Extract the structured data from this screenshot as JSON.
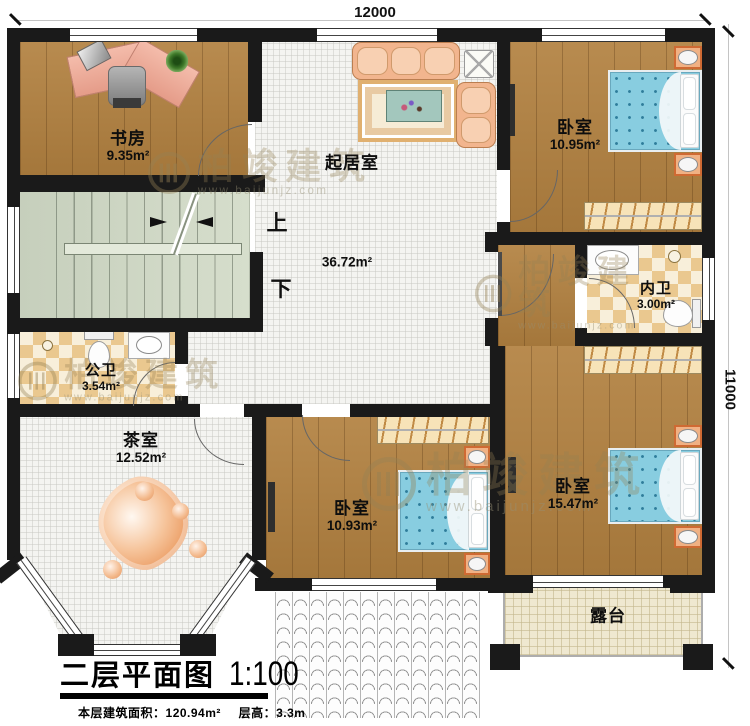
{
  "plan": {
    "dim_top": "12000",
    "dim_right": "11000",
    "stair_up": "上",
    "stair_down": "下"
  },
  "rooms": {
    "study": {
      "name": "书房",
      "area": "9.35m²"
    },
    "living": {
      "name": "起居室",
      "area": "36.72m²"
    },
    "bedroom_top_right": {
      "name": "卧室",
      "area": "10.95m²"
    },
    "inner_bath": {
      "name": "内卫",
      "area": "3.00m²"
    },
    "public_bath": {
      "name": "公卫",
      "area": "3.54m²"
    },
    "tea_room": {
      "name": "茶室",
      "area": "12.52m²"
    },
    "bedroom_bottom_center": {
      "name": "卧室",
      "area": "10.93m²"
    },
    "bedroom_bottom_right": {
      "name": "卧室",
      "area": "15.47m²"
    },
    "terrace": {
      "name": "露台"
    }
  },
  "title_block": {
    "title": "二层平面图",
    "scale": "1:100",
    "area_label": "本层建筑面积：",
    "area_value": "120.94m²",
    "height_label": "层高：",
    "height_value": "3.3m"
  },
  "watermark": {
    "brand": "柏竣建筑",
    "url": "www.baijunjz.com"
  },
  "colors": {
    "wall": "#1a1a1a",
    "wood_floor": "#b28140",
    "stair": "#cdd6c6",
    "bath_tile": "#eac88f",
    "terrace_tile": "#efe8d0",
    "bed_blue": "#88cde0",
    "sofa_peach": "#f2b58e",
    "nightstand_orange": "#f0b184"
  }
}
